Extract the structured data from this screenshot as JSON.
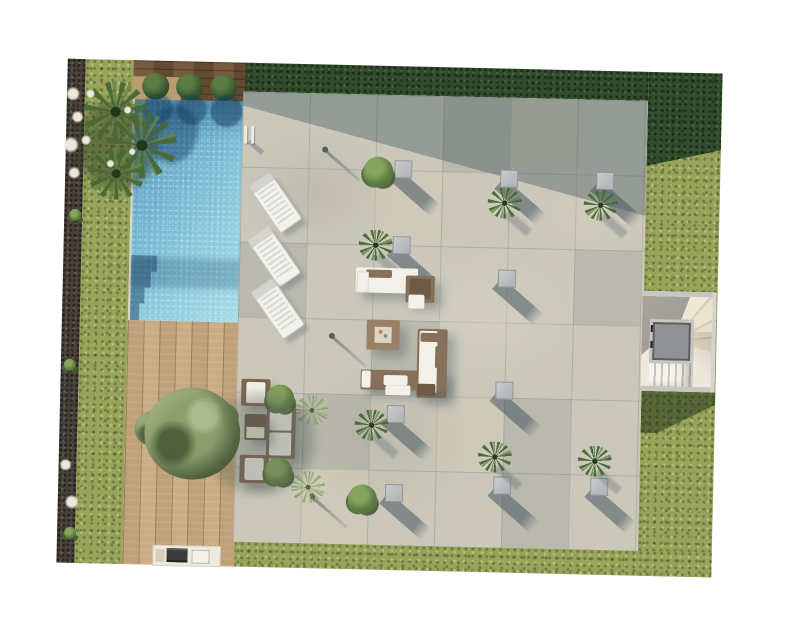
{
  "scene": {
    "title": "Villa garden site plan - top-down 3D render",
    "view": "top view",
    "background_color": "#ffffff",
    "areas": {
      "lawn": {
        "label": "Lawn",
        "color": "#9aa55c"
      },
      "hedge": {
        "label": "Perimeter hedge",
        "color": "#33502f"
      },
      "gravel_border": {
        "label": "Gravel planting border",
        "color": "#474039"
      },
      "pool": {
        "label": "Swimming pool",
        "color": "#6fb3cf"
      },
      "pool_head_deck": {
        "label": "Dark timber strip with box balls",
        "color": "#6e5236"
      },
      "timber_deck": {
        "label": "Timber deck",
        "color": "#c7a67c"
      },
      "patio": {
        "label": "Paved terrace",
        "color": "#cbc8bb"
      },
      "staircase": {
        "label": "Staircase with lift shaft",
        "color": "#eee8dc"
      }
    },
    "objects": {
      "sun_loungers": {
        "label": "Sun loungers",
        "count": 3
      },
      "box_balls": {
        "label": "Clipped box balls",
        "count": 3
      },
      "cube_planters": {
        "label": "Cube planters",
        "count": 10
      },
      "fan_palms": {
        "label": "Small fan palms",
        "count": 6
      },
      "shrubs": {
        "label": "Shrubs",
        "count": 4
      },
      "agaves": {
        "label": "Agaves",
        "count": 2
      },
      "palm_cluster": {
        "label": "Palm cluster with white blooms",
        "count": 1
      },
      "olive_tree": {
        "label": "Olive tree on deck",
        "count": 1
      },
      "lounge_set_firepit": {
        "label": "L-shaped lounge set with fire table",
        "count": 1
      },
      "lounge_set_chaise": {
        "label": "Sofa with chaise lounger",
        "count": 1
      },
      "lounge_set_tree": {
        "label": "Conversation set by tree",
        "count": 1
      },
      "fire_table": {
        "label": "Fire pit coffee table",
        "count": 1
      },
      "bbq_counter": {
        "label": "Outdoor kitchen BBQ counter",
        "count": 1
      },
      "pool_ladder": {
        "label": "Pool ladder",
        "count": 1
      },
      "lift_shaft": {
        "label": "Lift shaft skylight",
        "count": 1
      }
    }
  }
}
